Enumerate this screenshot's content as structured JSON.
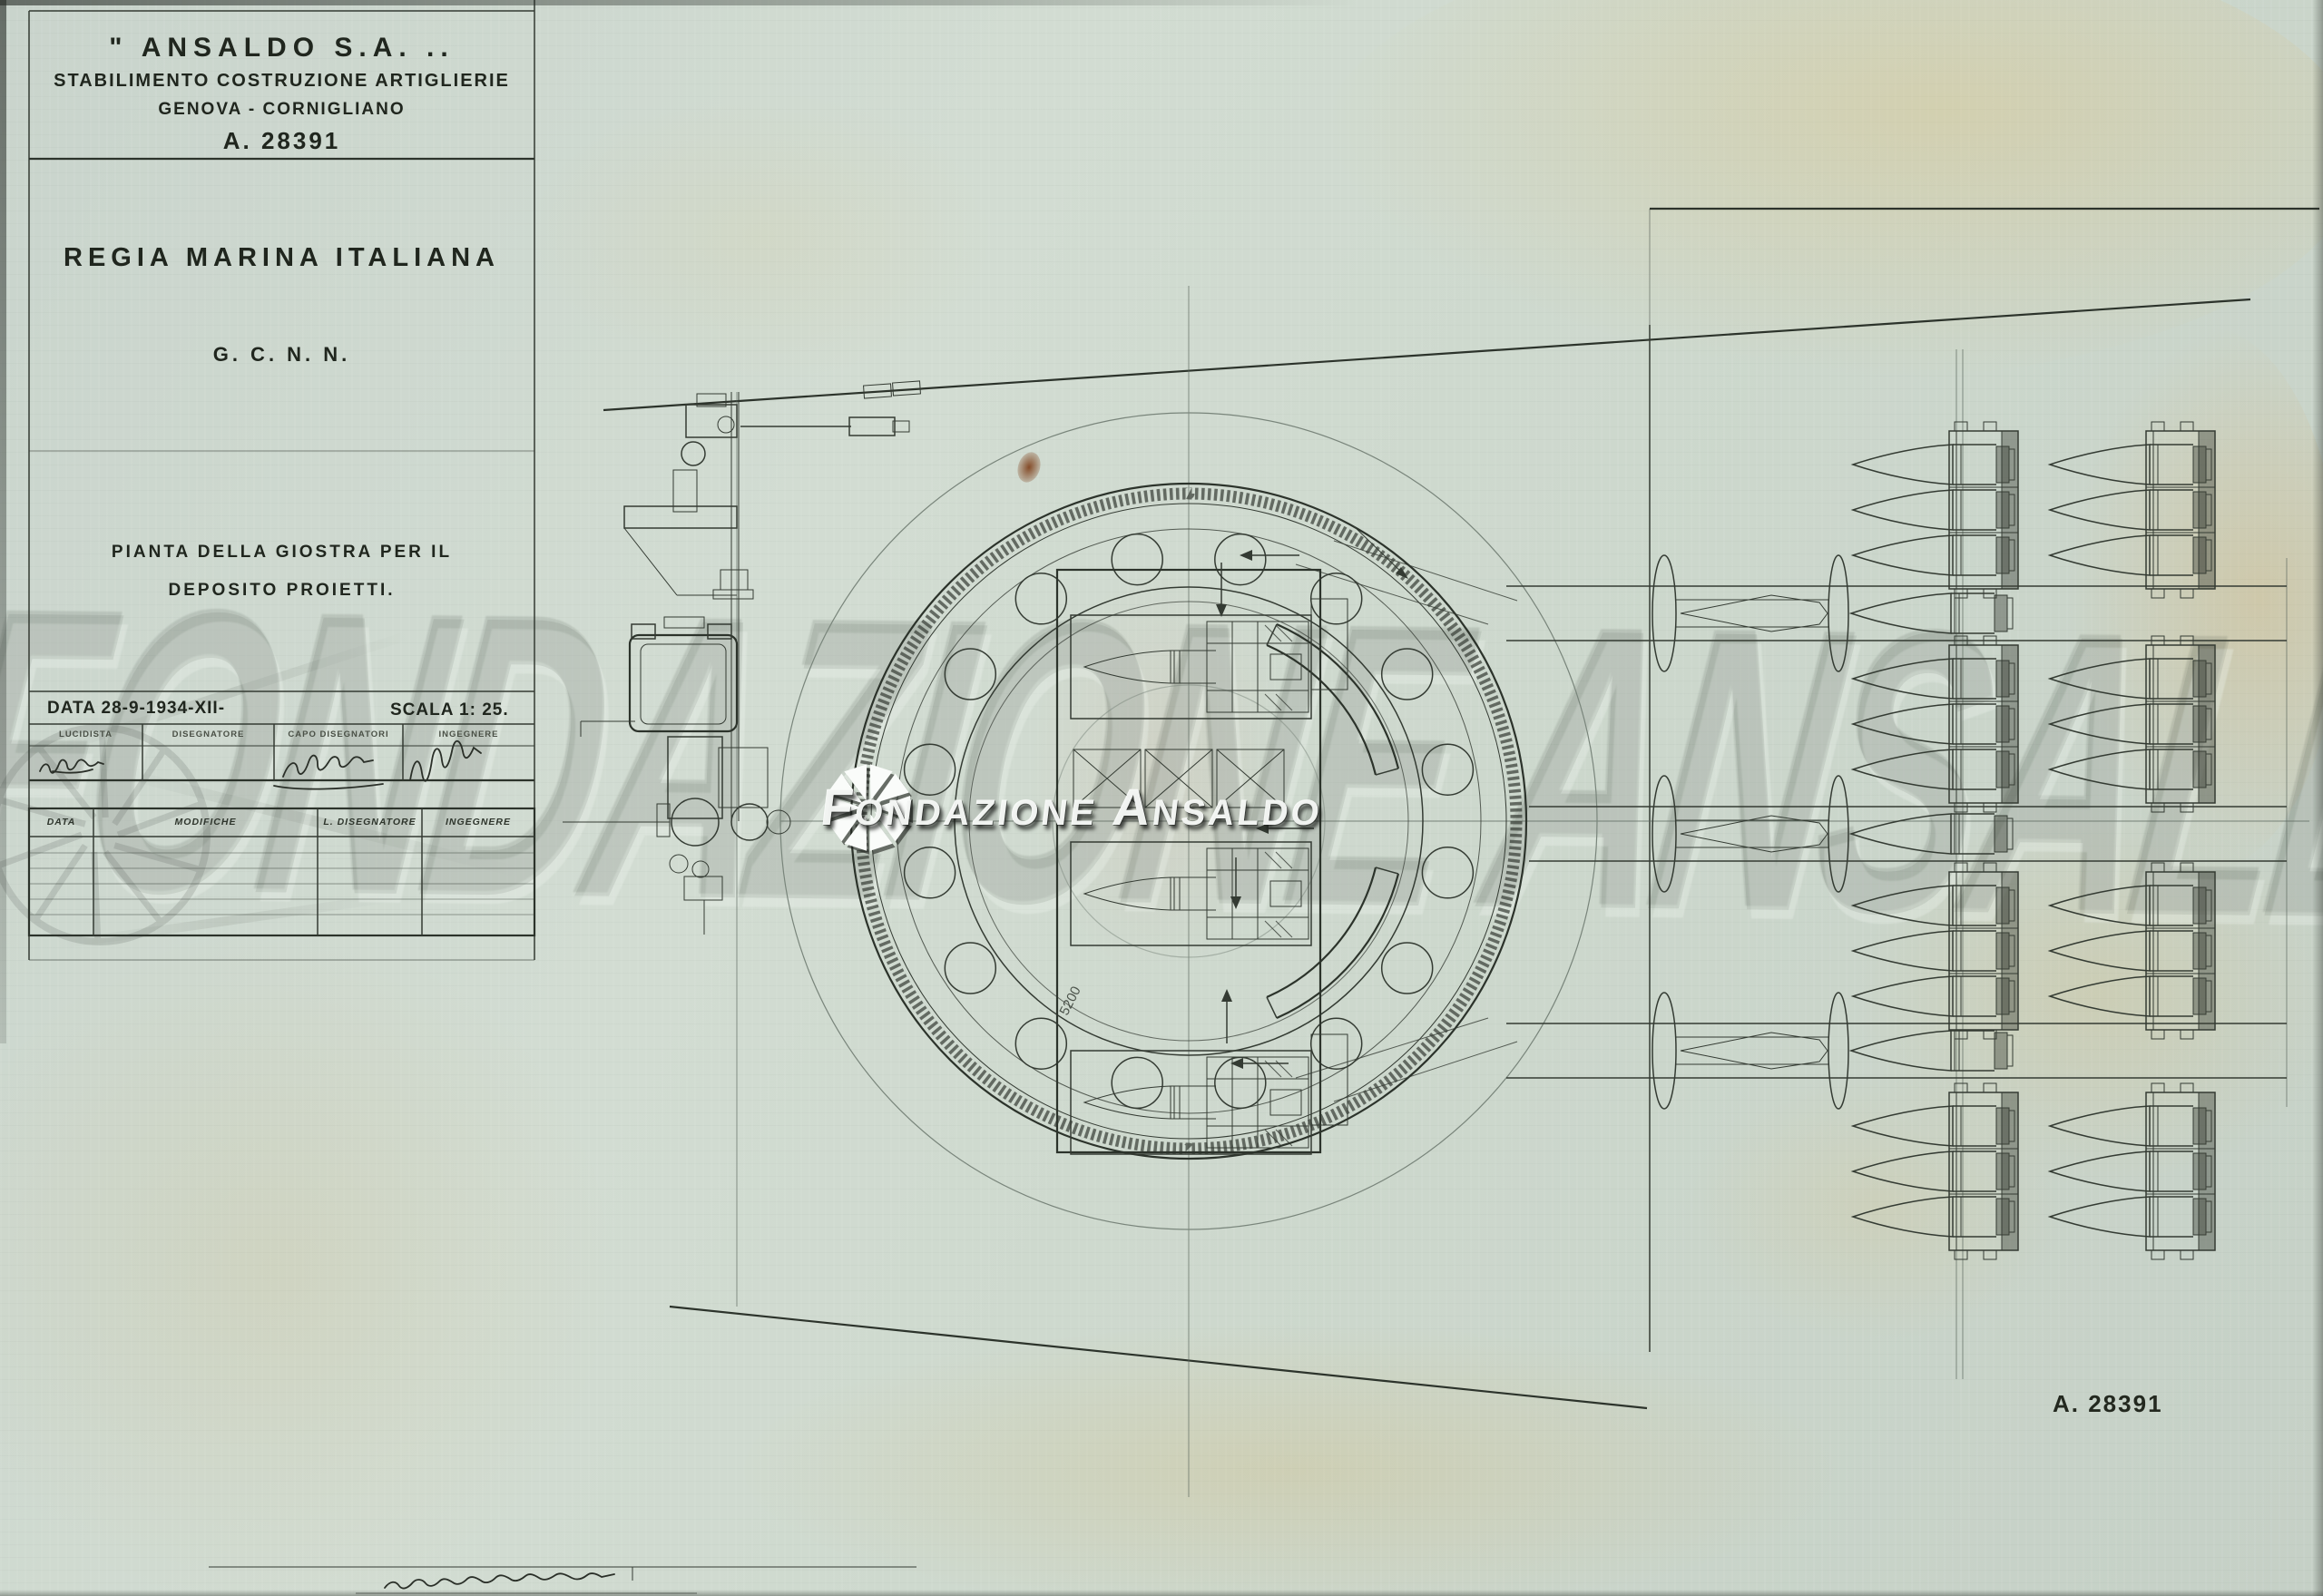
{
  "document": {
    "company_header": "\" ANSALDO  S.A. ..",
    "company_line2": "STABILIMENTO  COSTRUZIONE  ARTIGLIERIE",
    "company_line3": "GENOVA - CORNIGLIANO",
    "drawing_number": "A. 28391",
    "client": "REGIA  MARINA  ITALIANA",
    "ship_class": "G. C. N. N.",
    "title_line1": "PIANTA  DELLA  GIOSTRA  PER  IL",
    "title_line2": "DEPOSITO  PROIETTI.",
    "date_label": "DATA  28-9-1934-XII-",
    "scale_label": "SCALA  1: 25.",
    "signature_headers": [
      "LUCIDISTA",
      "DISEGNATORE",
      "CAPO  DISEGNATORI",
      "INGEGNERE"
    ],
    "revision_headers": [
      "DATA",
      "MODIFICHE",
      "L. DISEGNATORE",
      "INGEGNERE"
    ],
    "footer_number": "A. 28391",
    "dimension_label": "5200"
  },
  "watermark": {
    "text": "Fondazione Ansaldo",
    "ghost_text": "FONDAZIONE ANSALDO"
  },
  "colors": {
    "paper": "#ccd7cd",
    "ink": "#343b33",
    "faint_ink": "#79857b",
    "stain": "#d8b868",
    "rust": "#7c3c16",
    "watermark_white": "#fafcfa"
  }
}
